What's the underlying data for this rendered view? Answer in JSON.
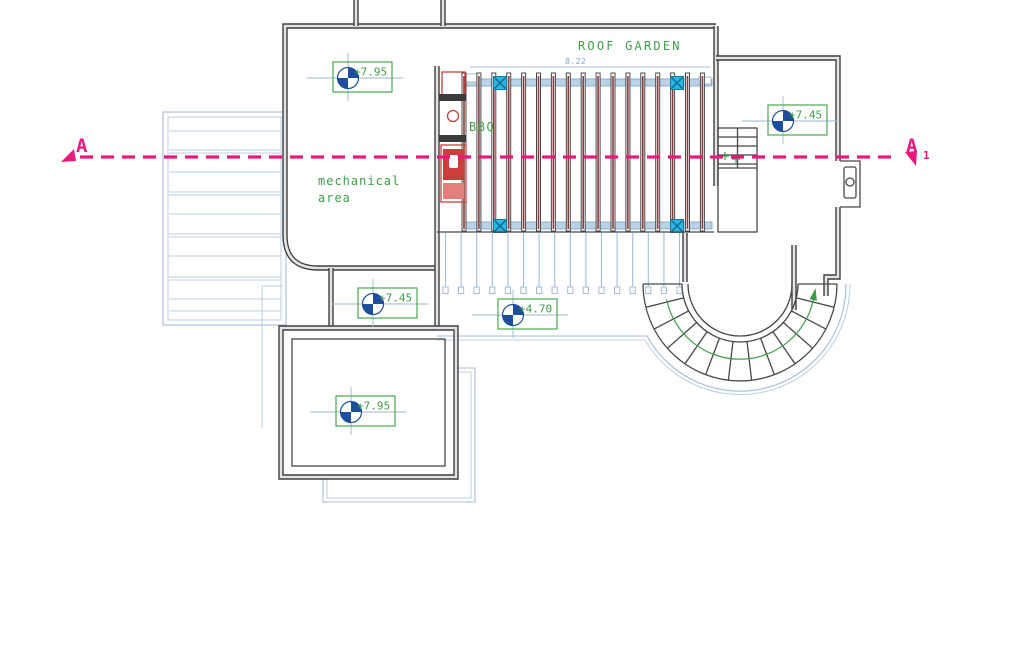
{
  "plan": {
    "labels": {
      "roof_garden": "ROOF GARDEN",
      "mechanical_line1": "mechanical",
      "mechanical_line2": "area",
      "bbq": "BBQ"
    },
    "section_line": {
      "left_label": "A",
      "right_label": "A",
      "right_subscript": "1"
    },
    "dimensions": {
      "pergola_width": "8.22"
    },
    "levels": [
      {
        "location": "mechanical-roof",
        "value": "+7.95"
      },
      {
        "location": "right-wing-roof",
        "value": "+7.45"
      },
      {
        "location": "west-corridor",
        "value": "+7.45"
      },
      {
        "location": "terrace",
        "value": "+4.70"
      },
      {
        "location": "south-room-roof",
        "value": "+7.95"
      }
    ],
    "colors": {
      "annotation_green": "#3f9e46",
      "section_pink": "#e81a7e",
      "wall_dark": "#3f3f3f",
      "cad_blue": "#a3bdd8",
      "post_cyan": "#2ab5e3",
      "slat_maroon": "#8a3a3a",
      "bbq_red": "#c94040",
      "marker_blue": "#1d4e9e"
    }
  }
}
